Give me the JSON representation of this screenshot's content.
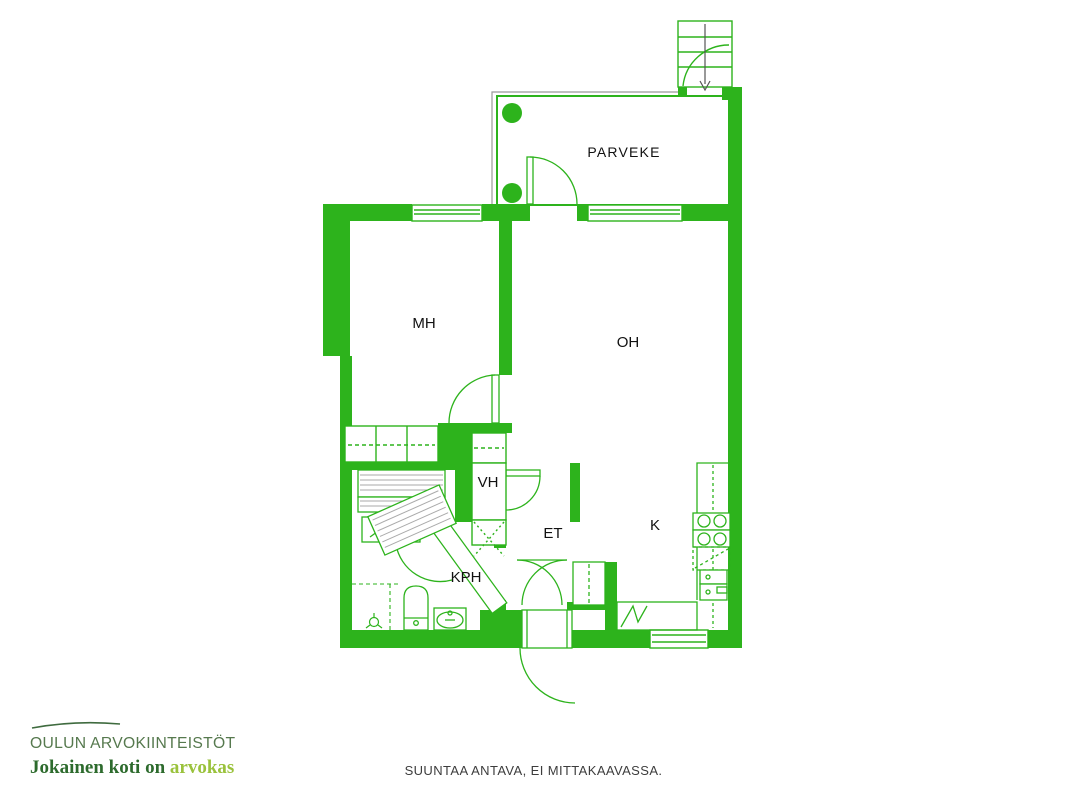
{
  "floor_plan": {
    "rooms": [
      {
        "id": "parveke",
        "label": "PARVEKE"
      },
      {
        "id": "mh",
        "label": "MH"
      },
      {
        "id": "oh",
        "label": "OH"
      },
      {
        "id": "vh",
        "label": "VH"
      },
      {
        "id": "et",
        "label": "ET"
      },
      {
        "id": "k",
        "label": "K"
      },
      {
        "id": "kph",
        "label": "KPH"
      }
    ],
    "fixtures": [
      "stairs",
      "balcony-posts",
      "windows",
      "wardrobe",
      "closets",
      "washing-machine",
      "electric-appliance",
      "toilet",
      "sink",
      "floor-drain",
      "stove",
      "dishwasher-reservation",
      "fridge",
      "kitchen-counter",
      "doors"
    ]
  },
  "branding": {
    "company": "OULUN ARVOKIINTEISTÖT",
    "tagline_dark": "Jokainen koti on",
    "tagline_accent": "arvokas"
  },
  "footer": {
    "disclaimer": "SUUNTAA ANTAVA, EI MITTAKAAVASSA."
  },
  "colors": {
    "wall_green": "#2db31c",
    "logo_title_green": "#56794e",
    "tagline_green": "#2d6b2d",
    "tagline_accent_green": "#9ac23c",
    "label_text": "#111111",
    "disclaimer_text": "#3d3d3d",
    "guide_gray": "#999999"
  }
}
